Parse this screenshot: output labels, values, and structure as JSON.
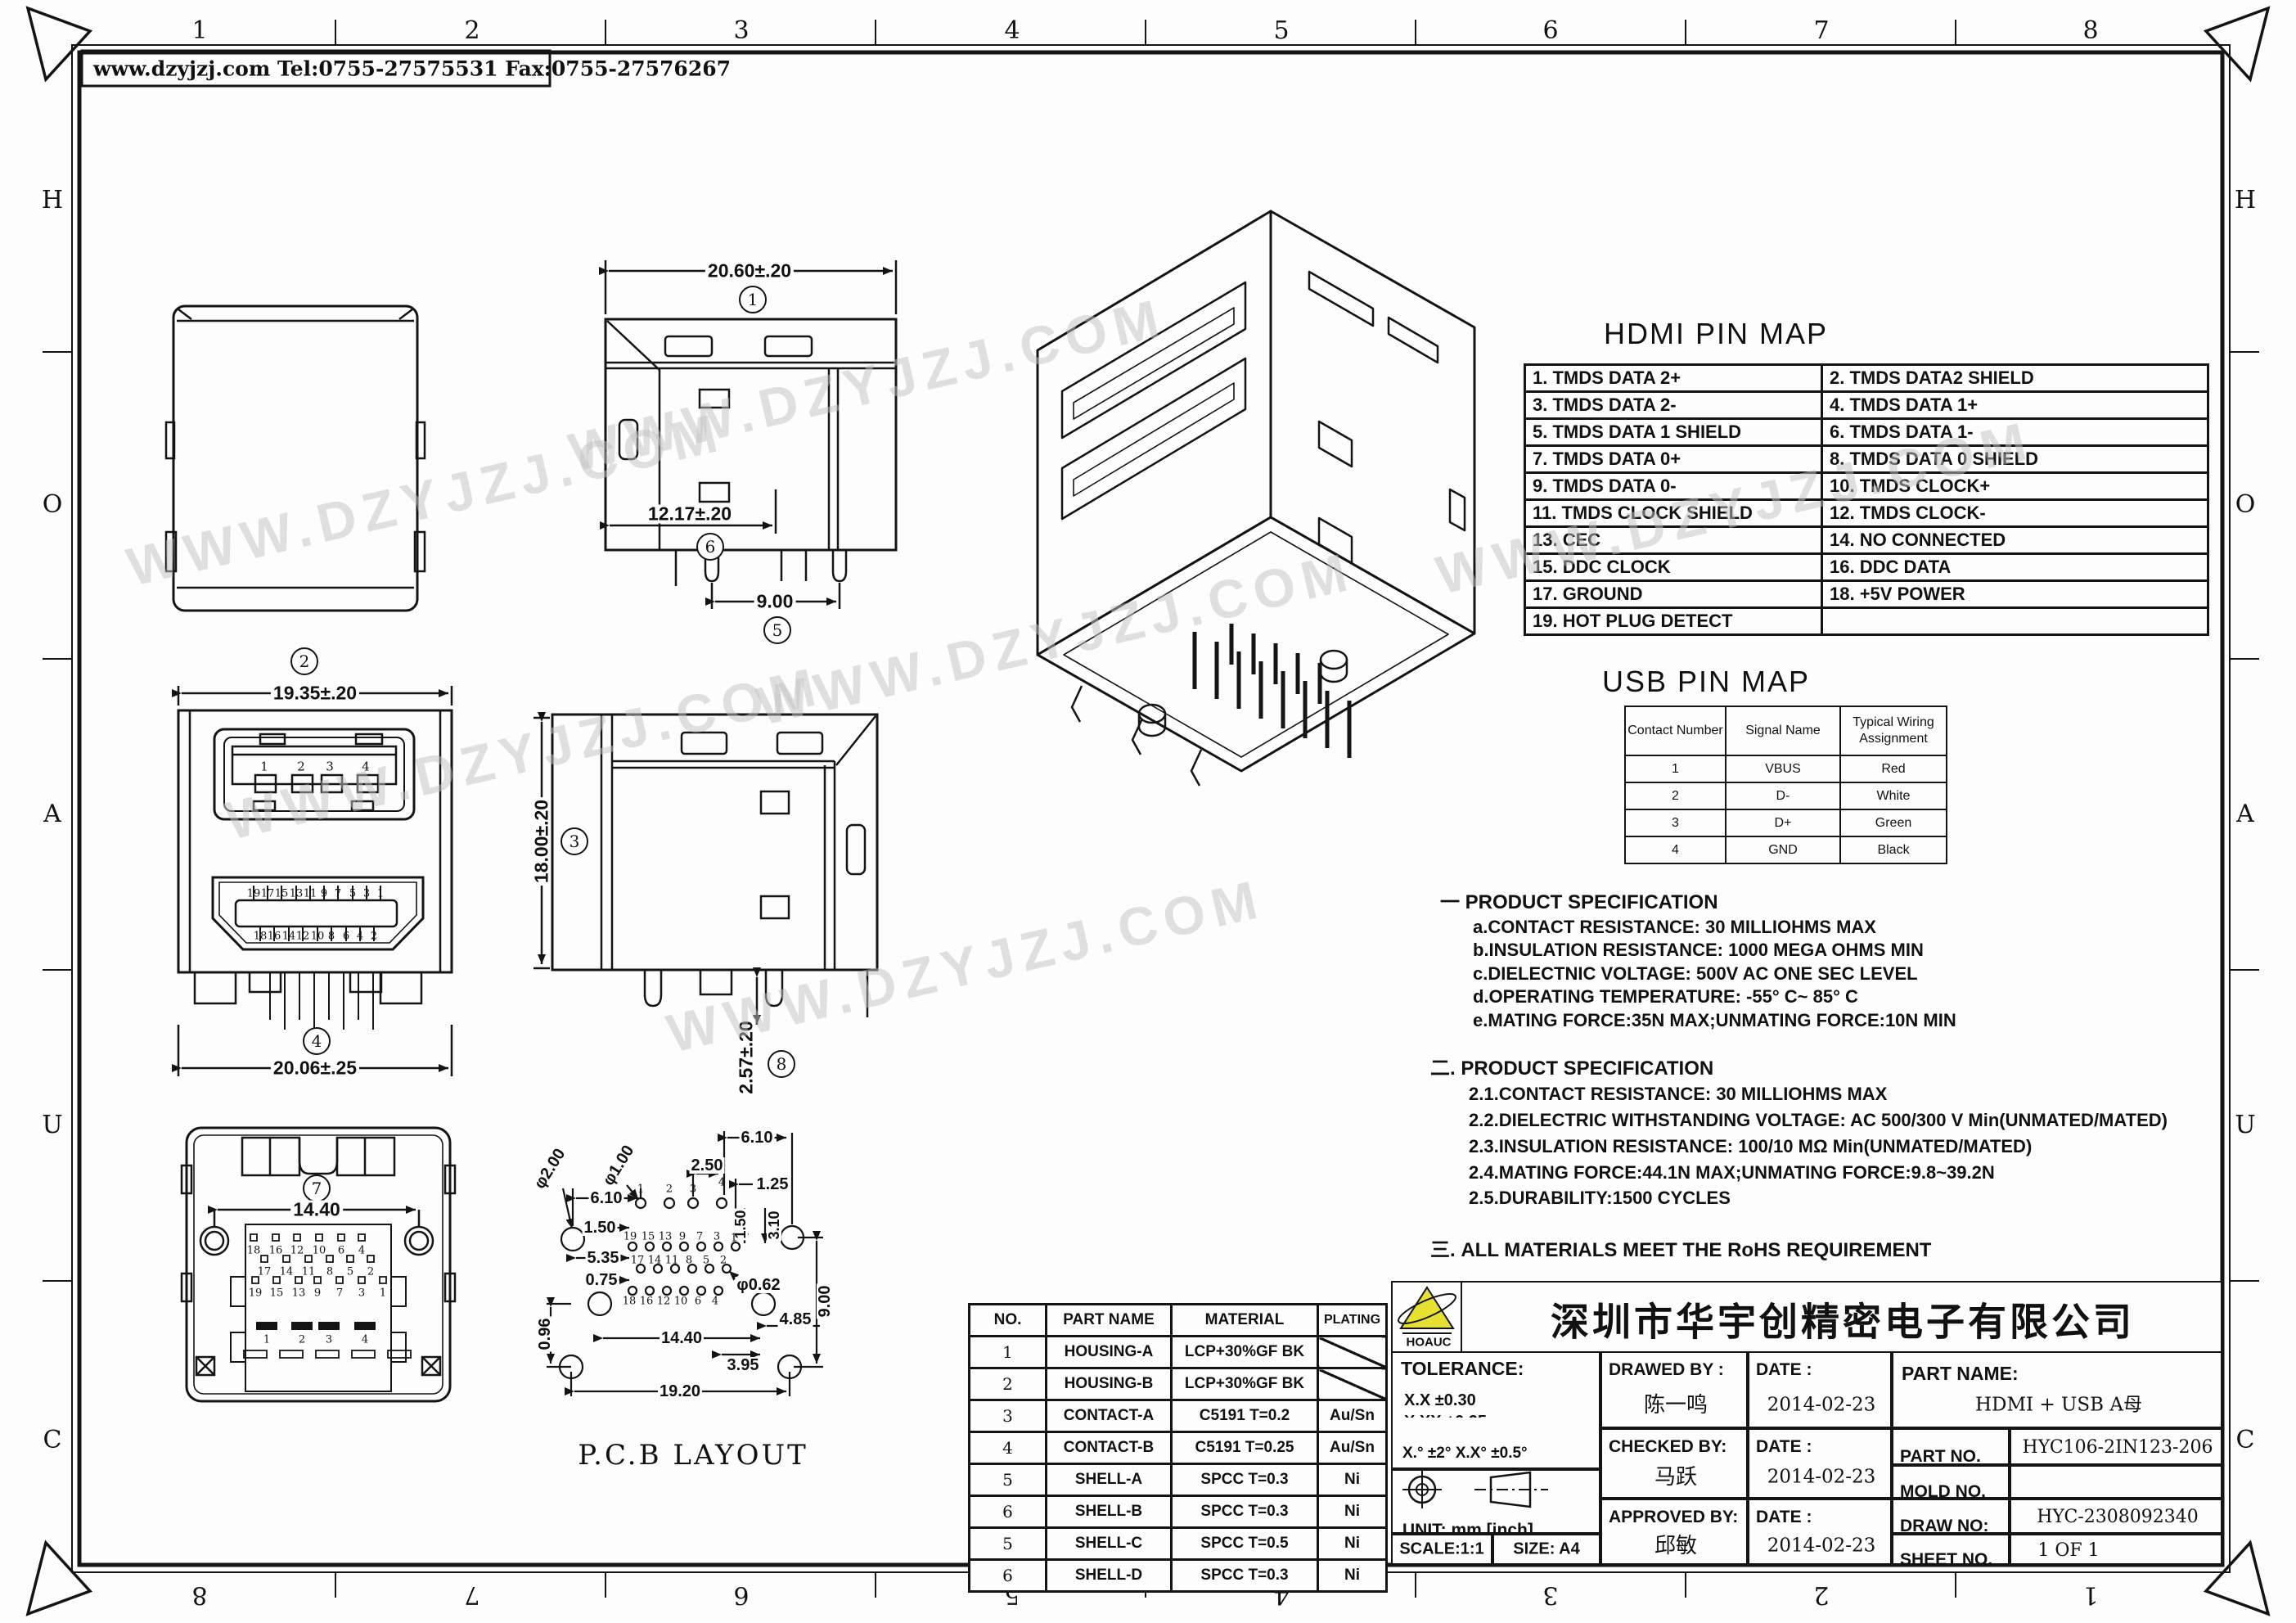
{
  "drawing": {
    "contact_header": "www.dzyjzj.com   Tel:0755-27575531   Fax:0755-27576267",
    "watermark": "WWW.DZYJZJ.COM",
    "zones": {
      "top": [
        "1",
        "2",
        "3",
        "4",
        "5",
        "6",
        "7",
        "8"
      ],
      "bottom": [
        "8",
        "7",
        "6",
        "5",
        "4",
        "3",
        "2",
        "1"
      ],
      "left": [
        "H",
        "O",
        "A",
        "U",
        "C"
      ],
      "right": [
        "H",
        "O",
        "A",
        "U",
        "C"
      ]
    }
  },
  "views": {
    "v1": {
      "balloon": "1",
      "dim_width": "20.60±.20",
      "balloon_pitch": "6",
      "dim_pitch": "12.17±.20",
      "balloon_span": "5",
      "dim_span": "9.00"
    },
    "v2": {
      "balloon": "2"
    },
    "v3": {
      "balloon": "3",
      "dim_height": "18.00±.20",
      "balloon_pin": "8",
      "dim_pin": "2.57±.20"
    },
    "v4": {
      "balloon": "4",
      "dim_top": "19.35±.20",
      "dim_bottom": "20.06±.25",
      "usb_pins": [
        "1",
        "2",
        "3",
        "4"
      ],
      "hdmi_top_pins": [
        "19",
        "17",
        "15",
        "13",
        "11",
        "9",
        "7",
        "5",
        "3",
        "1"
      ],
      "hdmi_bottom_pins": [
        "18",
        "16",
        "14",
        "12",
        "10",
        "8",
        "6",
        "4",
        "2"
      ]
    },
    "v7": {
      "balloon": "7",
      "dim": "14.40",
      "row_a": [
        "18",
        "16",
        "12",
        "10",
        "6",
        "4"
      ],
      "row_b": [
        "17",
        "14",
        "11",
        "8",
        "5",
        "2"
      ],
      "row_c": [
        "19",
        "15",
        "13",
        "9",
        "7",
        "3",
        "1"
      ],
      "pads": [
        "1",
        "2",
        "3",
        "4"
      ]
    },
    "pcb": {
      "title": "P.C.B   LAYOUT",
      "hole_big": "φ2.00",
      "hole_small": "φ1.00",
      "hole_pin": "φ0.62",
      "dim_610_top": "6.10",
      "dim_250": "2.50",
      "dim_125": "1.25",
      "dim_610_left": "6.10",
      "dim_150_left": "1.50",
      "dim_150_v": "1.50",
      "dim_310": "3.10",
      "dim_535": "5.35",
      "dim_075": "0.75",
      "dim_096": "0.96",
      "dim_1440": "14.40",
      "dim_395": "3.95",
      "dim_485": "4.85",
      "dim_900": "9.00",
      "dim_1920": "19.20",
      "pins_top": [
        "1",
        "2",
        "3",
        "4"
      ],
      "row_1": [
        "19",
        "15",
        "13",
        "9",
        "7",
        "3",
        "1"
      ],
      "row_2": [
        "17",
        "14",
        "11",
        "8",
        "5",
        "2"
      ],
      "row_3": [
        "18",
        "16",
        "12",
        "10",
        "6",
        "4"
      ]
    }
  },
  "hdmi_map": {
    "title": "HDMI PIN MAP",
    "rows": [
      [
        "1.  TMDS  DATA 2+",
        "2.  TMDS DATA2  SHIELD"
      ],
      [
        "3.  TMDS  DATA 2-",
        "4.  TMDS DATA 1+"
      ],
      [
        "5.  TMDS DATA 1 SHIELD",
        "6.  TMDS DATA 1-"
      ],
      [
        "7.  TMDS DATA  0+",
        "8.  TMDS DATA 0 SHIELD"
      ],
      [
        "9.  TMDS  DATA  0-",
        "10.  TMDS  CLOCK+"
      ],
      [
        "11.  TMDS  CLOCK SHIELD",
        "12.  TMDS  CLOCK-"
      ],
      [
        "13.  CEC",
        "14.  NO CONNECTED"
      ],
      [
        "15.  DDC CLOCK",
        "16.  DDC DATA"
      ],
      [
        "17.  GROUND",
        "18.  +5V POWER"
      ],
      [
        "19.  HOT  PLUG  DETECT",
        ""
      ]
    ]
  },
  "usb_map": {
    "title": "USB PIN MAP",
    "headers": [
      "Contact Number",
      "Signal Name",
      "Typical Wiring Assignment"
    ],
    "rows": [
      [
        "1",
        "VBUS",
        "Red"
      ],
      [
        "2",
        "D-",
        "White"
      ],
      [
        "3",
        "D+",
        "Green"
      ],
      [
        "4",
        "GND",
        "Black"
      ]
    ]
  },
  "specs": {
    "sec1_title": "一  PRODUCT SPECIFICATION",
    "sec1": [
      "a.CONTACT RESISTANCE: 30 MILLIOHMS MAX",
      "b.INSULATION RESISTANCE: 1000 MEGA OHMS MIN",
      "c.DIELECTNIC VOLTAGE: 500V AC ONE SEC LEVEL",
      "d.OPERATING TEMPERATURE: -55° C~ 85° C",
      "e.MATING FORCE:35N MAX;UNMATING FORCE:10N MIN"
    ],
    "sec2_title": "二. PRODUCT SPECIFICATION",
    "sec2": [
      "2.1.CONTACT RESISTANCE: 30 MILLIOHMS MAX",
      "2.2.DIELECTRIC WITHSTANDING VOLTAGE: AC 500/300 V Min(UNMATED/MATED)",
      "2.3.INSULATION RESISTANCE: 100/10 MΩ Min(UNMATED/MATED)",
      "2.4.MATING FORCE:44.1N MAX;UNMATING FORCE:9.8~39.2N",
      "2.5.DURABILITY:1500 CYCLES"
    ],
    "sec3": "三. ALL MATERIALS MEET THE RoHS REQUIREMENT"
  },
  "parts_table": {
    "headers": [
      "NO.",
      "PART NAME",
      "MATERIAL",
      "PLATING"
    ],
    "rows": [
      [
        "1",
        "HOUSING-A",
        "LCP+30%GF    BK",
        ""
      ],
      [
        "2",
        "HOUSING-B",
        "LCP+30%GF    BK",
        ""
      ],
      [
        "3",
        "CONTACT-A",
        "C5191  T=0.2",
        "Au/Sn"
      ],
      [
        "4",
        "CONTACT-B",
        "C5191  T=0.25",
        "Au/Sn"
      ],
      [
        "5",
        "SHELL-A",
        "SPCC  T=0.3",
        "Ni"
      ],
      [
        "6",
        "SHELL-B",
        "SPCC  T=0.3",
        "Ni"
      ],
      [
        "5",
        "SHELL-C",
        "SPCC  T=0.5",
        "Ni"
      ],
      [
        "6",
        "SHELL-D",
        "SPCC  T=0.3",
        "Ni"
      ]
    ]
  },
  "title_block": {
    "logo_text": "HOAUC",
    "company": "深圳市华宇创精密电子有限公司",
    "tolerance_label": "TOLERANCE:",
    "tol_1": "X.X      ±0.30",
    "tol_2": "X.XX    ±0.25",
    "tol_3": "X.XXX  ±0.15",
    "tol_angle": "X.°  ±2°         X.X°  ±0.5°",
    "unit_label": "UNIT:  mm  [inch]",
    "scale_label": "SCALE:1:1",
    "size_label": "SIZE:  A4",
    "drawed_label": "DRAWED  BY :",
    "drawed_by": "陈一鸣",
    "date_label_1": "DATE :",
    "date_1": "2014-02-23",
    "checked_label": "CHECKED  BY:",
    "checked_by": "马跃",
    "date_label_2": "DATE :",
    "date_2": "2014-02-23",
    "approved_label": "APPROVED  BY:",
    "approved_by": "邱敏",
    "date_label_3": "DATE :",
    "date_3": "2014-02-23",
    "part_name_label": "PART  NAME:",
    "part_name": "HDMI + USB A母",
    "part_no_label": "PART  NO.",
    "part_no": "HYC106-2IN123-206",
    "mold_no_label": "MOLD  NO.",
    "draw_no_label": "DRAW  NO:",
    "draw_no": "HYC-2308092340",
    "sheet_no_label": "SHEET  NO.",
    "sheet_no": "1 OF 1"
  },
  "colors": {
    "line": "#141414",
    "logo_yellow": "#e6e030",
    "watermark": "#c3c3c3"
  }
}
